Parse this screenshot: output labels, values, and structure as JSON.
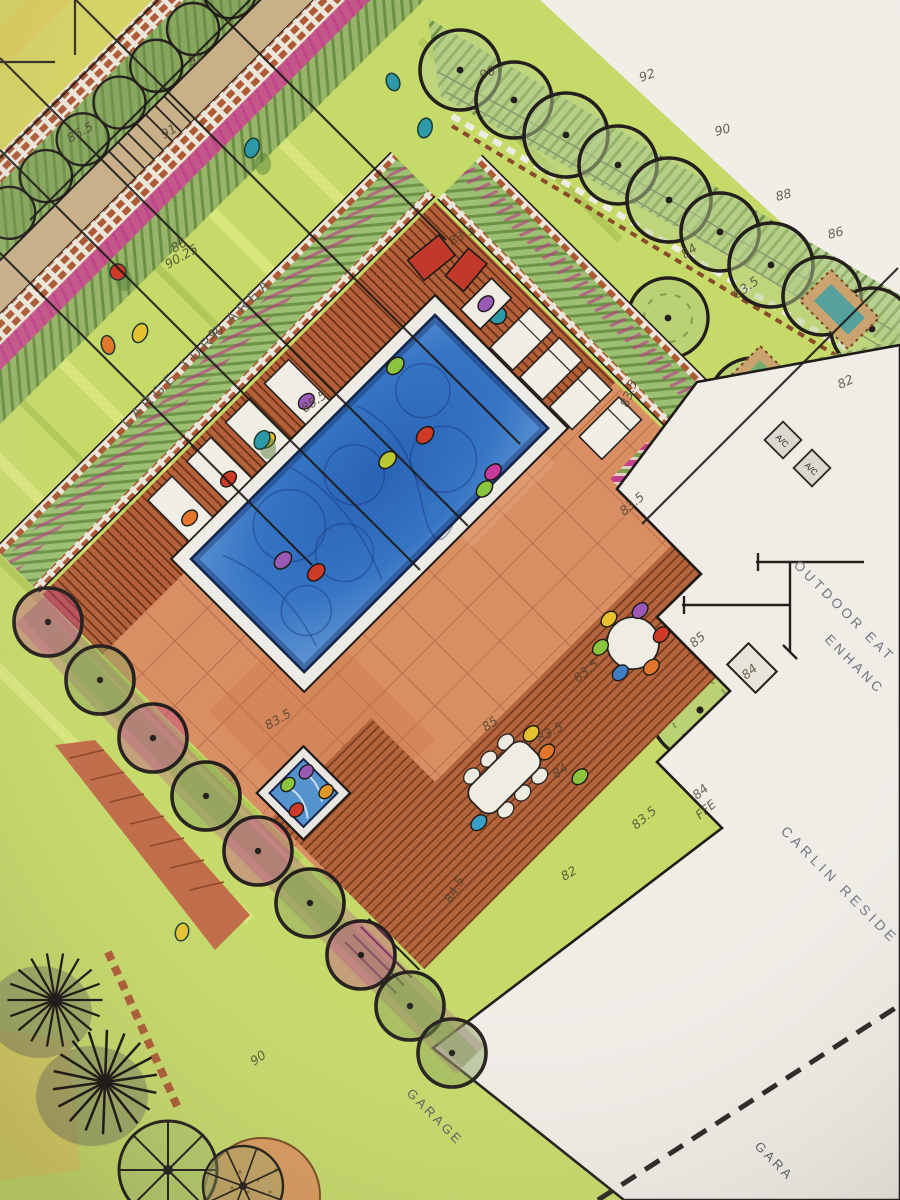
{
  "labels": {
    "turf_area": "LARGE TURF AREA",
    "outdoor_eating": "OUTDOOR EAT",
    "enhanced": "ENHANC",
    "residence": "CARLIN RESIDE",
    "garage": "GARAGE",
    "garage2": "GARA",
    "ac_unit_1": "A/C",
    "ac_unit_2": "A/C",
    "ffe_value": "84",
    "ffe_label": "FFE"
  },
  "annotations": [
    {
      "t": "92",
      "x": 641,
      "y": 82,
      "r": -20
    },
    {
      "t": "90",
      "x": 716,
      "y": 136,
      "r": -15
    },
    {
      "t": "88",
      "x": 777,
      "y": 201,
      "r": -15
    },
    {
      "t": "86",
      "x": 829,
      "y": 239,
      "r": -15
    },
    {
      "t": "84",
      "x": 685,
      "y": 259,
      "r": -35
    },
    {
      "t": "83.5",
      "x": 737,
      "y": 299,
      "r": -35
    },
    {
      "t": "82",
      "x": 840,
      "y": 389,
      "r": -25
    },
    {
      "t": "90",
      "x": 482,
      "y": 80,
      "r": -25
    },
    {
      "t": "95",
      "x": 191,
      "y": 66,
      "r": -30
    },
    {
      "t": "91",
      "x": 164,
      "y": 139,
      "r": -30
    },
    {
      "t": "86.5",
      "x": 70,
      "y": 143,
      "r": -30
    },
    {
      "t": "86",
      "x": 174,
      "y": 253,
      "r": -30
    },
    {
      "t": "90.25",
      "x": 168,
      "y": 269,
      "r": -30
    },
    {
      "t": "90",
      "x": 211,
      "y": 340,
      "r": -30
    },
    {
      "t": "83.5",
      "x": 452,
      "y": 246,
      "r": -30
    },
    {
      "t": "85.5",
      "x": 305,
      "y": 413,
      "r": -35,
      "s": 15
    },
    {
      "t": "83.5",
      "x": 624,
      "y": 516,
      "r": -40
    },
    {
      "t": "83.5",
      "x": 628,
      "y": 408,
      "r": -70
    },
    {
      "t": "85",
      "x": 694,
      "y": 648,
      "r": -40
    },
    {
      "t": "83.5",
      "x": 578,
      "y": 683,
      "r": -40,
      "s": 15
    },
    {
      "t": "83.5",
      "x": 268,
      "y": 730,
      "r": -30
    },
    {
      "t": "85",
      "x": 486,
      "y": 732,
      "r": -35
    },
    {
      "t": "83.5",
      "x": 540,
      "y": 743,
      "r": -30
    },
    {
      "t": "84",
      "x": 556,
      "y": 779,
      "r": -35
    },
    {
      "t": "83.5",
      "x": 636,
      "y": 830,
      "r": -40
    },
    {
      "t": "82",
      "x": 564,
      "y": 881,
      "r": -30
    },
    {
      "t": "84.5",
      "x": 451,
      "y": 904,
      "r": -60
    },
    {
      "t": "84",
      "x": 746,
      "y": 680,
      "r": -40
    },
    {
      "t": "90",
      "x": 254,
      "y": 1066,
      "r": -35
    }
  ],
  "colors": {
    "pool_blue": "#2f6cbe",
    "turf_green": "#c6da69",
    "paving_terracotta": "#d98f63",
    "deck_wood": "#b2613a",
    "planting_magenta": "#c2408e",
    "hedge_green": "#8fb066",
    "ink_black": "#1c1916",
    "paper": "#efece6",
    "label_grey": "#6f7480"
  }
}
